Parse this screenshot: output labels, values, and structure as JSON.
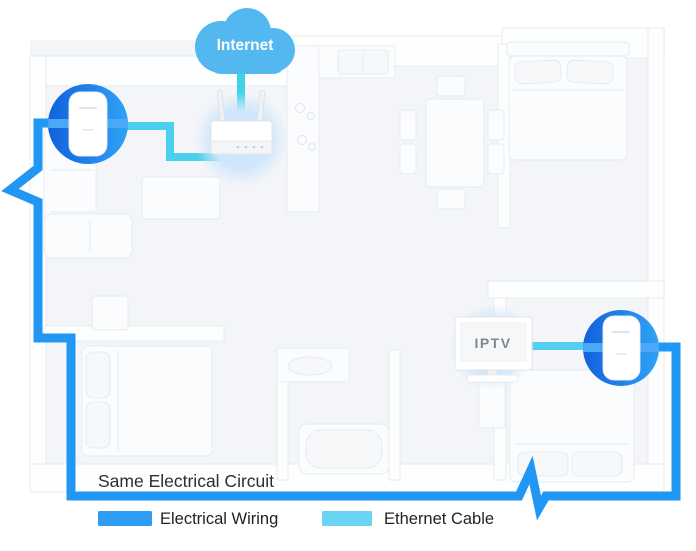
{
  "diagram": {
    "internet_label": "Internet",
    "iptv_label": "IPTV",
    "same_circuit_label": "Same Electrical Circuit"
  },
  "legend": {
    "electrical": {
      "label": "Electrical Wiring",
      "color": "#2e9cf2"
    },
    "ethernet": {
      "label": "Ethernet Cable",
      "color": "#69d5f4"
    }
  },
  "colors": {
    "cloud": "#53b7f0",
    "electrical_line": "#2196f3",
    "ethernet_line": "#4ad0ec",
    "adapter_circle_dark": "#1161dc",
    "adapter_circle_light": "#2fa3f5",
    "device_glow": "#cfe6fb"
  }
}
